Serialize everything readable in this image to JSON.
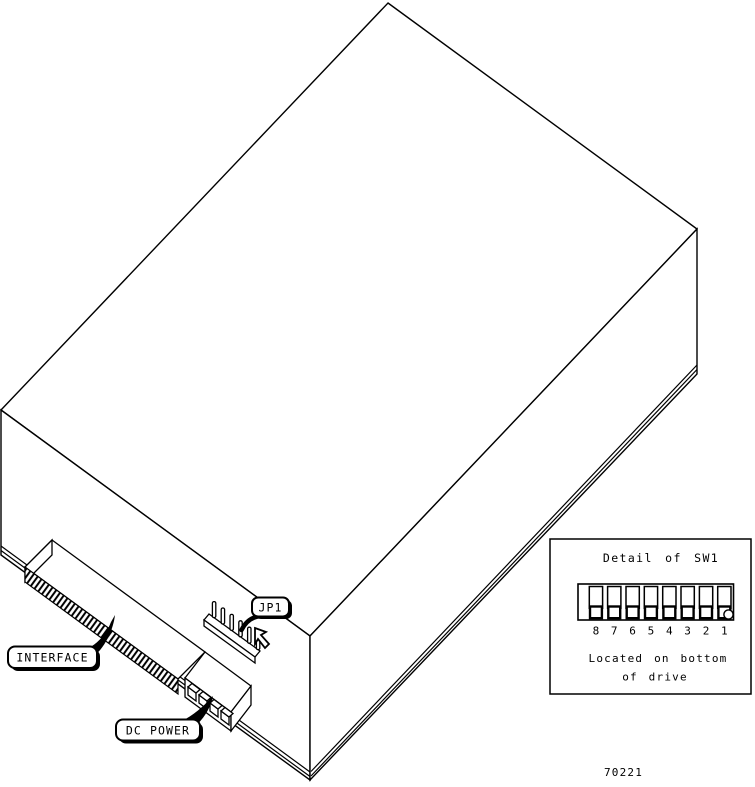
{
  "diagram": {
    "type": "isometric-drive-connector-diagram",
    "callouts": {
      "interface": "INTERFACE",
      "dc_power": "DC POWER",
      "jp1": "JP1"
    },
    "detail_panel": {
      "title": "Detail of SW1",
      "switch_numbers": [
        "8",
        "7",
        "6",
        "5",
        "4",
        "3",
        "2",
        "1"
      ],
      "switch_count": 8,
      "actuator_position": "bottom",
      "note_line1": "Located on bottom",
      "note_line2": "of drive"
    },
    "figure_number": "70221",
    "colors": {
      "line": "#000000",
      "background": "#ffffff"
    }
  }
}
